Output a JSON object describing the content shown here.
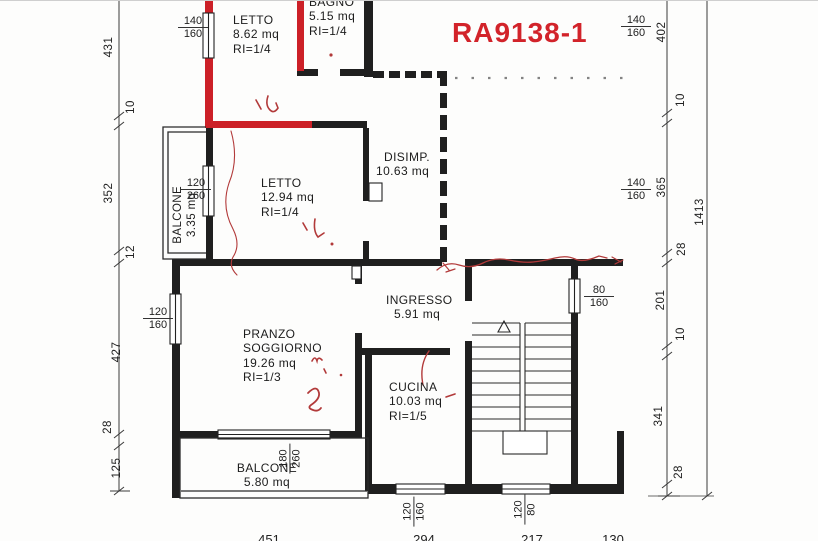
{
  "plan": {
    "code": "RA9138-1",
    "type": "apartment-floor-plan"
  },
  "rooms": {
    "letto1": {
      "name": "LETTO",
      "area": "8.62  mq",
      "ri": "RI=1/4"
    },
    "bagno": {
      "name": "BAGNO",
      "area": "5.15  mq",
      "ri": "RI=1/4"
    },
    "letto2": {
      "name": "LETTO",
      "area": "12.94  mq",
      "ri": "RI=1/4"
    },
    "disimpegno": {
      "name": "DISIMP.",
      "area": "10.63  mq"
    },
    "ingresso": {
      "name": "INGRESSO",
      "area": "5.91  mq"
    },
    "soggiorno": {
      "name_line1": "PRANZO",
      "name_line2": "SOGGIORNO",
      "area": "19.26  mq",
      "ri": "RI=1/3"
    },
    "cucina": {
      "name": "CUCINA",
      "area": "10.03  mq",
      "ri": "RI=1/5"
    },
    "balcone1": {
      "name": "BALCONE",
      "area": "3.35  mq"
    },
    "balcone2": {
      "name": "BALCONE",
      "area": "5.80  mq"
    }
  },
  "dims": {
    "left": [
      "431",
      "10",
      "352",
      "12",
      "427",
      "28",
      "125"
    ],
    "right": [
      "402",
      "10",
      "365",
      "28",
      "201",
      "10",
      "341",
      "28"
    ],
    "total": "1413",
    "bottom": [
      "451",
      "294",
      "217",
      "130"
    ]
  },
  "openings": {
    "win_letto1": {
      "w": "140",
      "h": "160"
    },
    "win_top_right": {
      "w": "140",
      "h": "160"
    },
    "win_mid_right": {
      "w": "140",
      "h": "160"
    },
    "door_balcone1": {
      "w": "120",
      "h": "260"
    },
    "win_soggiorno": {
      "w": "120",
      "h": "160"
    },
    "win_stairs": {
      "w": "80",
      "h": "160"
    },
    "door_balcone2": {
      "w": "180",
      "h": "260"
    },
    "win_cucina": {
      "w": "120",
      "h": "160"
    },
    "win_bottom_right": {
      "w": "120",
      "h": "80"
    }
  },
  "handwritten_marks": [
    "1",
    "1.",
    "2",
    "n,"
  ],
  "colors": {
    "highlight_red": "#cc2027",
    "annotation_red": "#b23a3a",
    "wall_black": "#1f1f1f",
    "code_red": "#d2232a"
  }
}
